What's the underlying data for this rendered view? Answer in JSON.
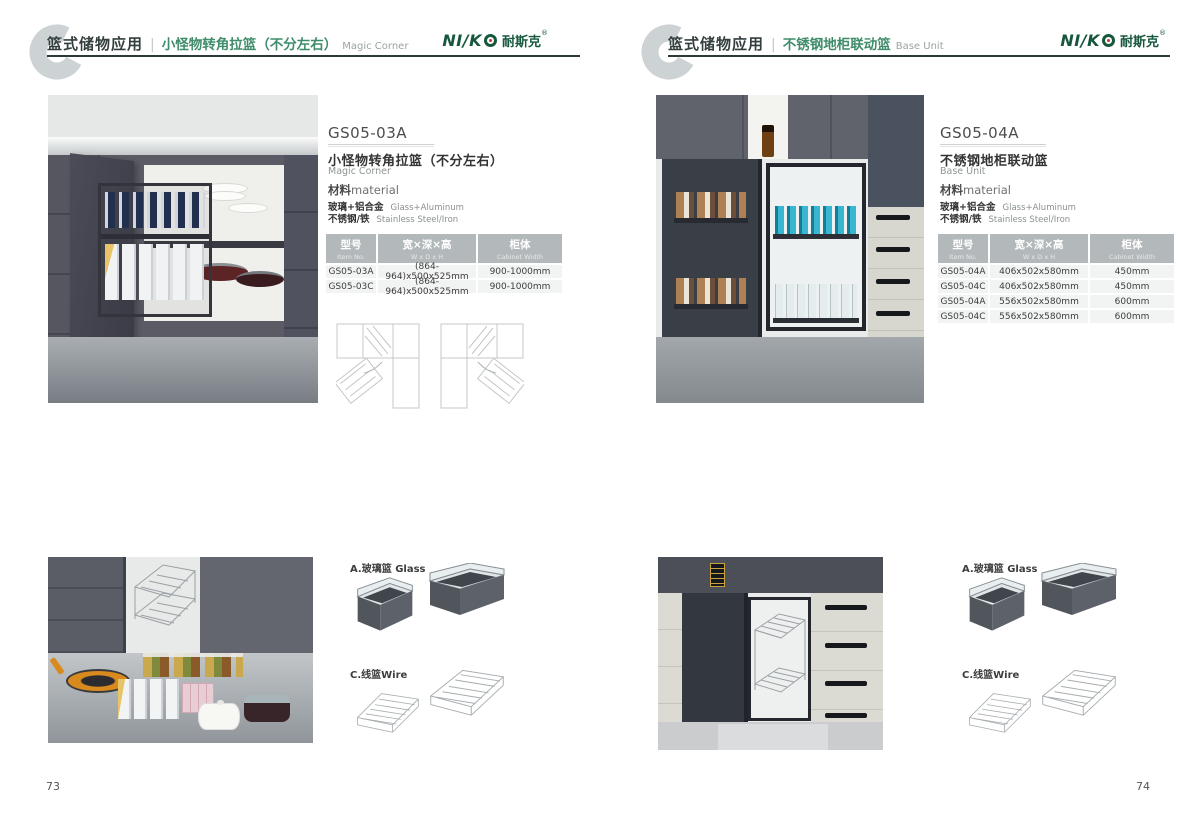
{
  "brand": {
    "latin": "NI/K",
    "cn": "耐斯克",
    "reg": "®"
  },
  "colors": {
    "accent_green": "#3f8c6a",
    "logo_green": "#17573d",
    "header_rule": "#2c3937",
    "table_header_gray": "#b3b9bb"
  },
  "pages": [
    {
      "page_number": "73",
      "header": {
        "category_cn": "篮式储物应用",
        "divider": "|",
        "title_cn": "小怪物转角拉篮（不分左右）",
        "title_en": "Magic Corner"
      },
      "product": {
        "code": "GS05-03A",
        "name_cn": "小怪物转角拉篮（不分左右）",
        "name_en": "Magic Corner"
      },
      "material": {
        "label_cn": "材料",
        "label_en": "material",
        "rows": [
          {
            "cn": "玻璃+铝合金",
            "en": "Glass+Aluminum"
          },
          {
            "cn": "不锈钢/铁",
            "en": "Stainless Steel/Iron"
          }
        ]
      },
      "spec_table": {
        "headers": [
          {
            "cn": "型号",
            "en": "Item No."
          },
          {
            "cn": "宽×深×高",
            "en": "W x D x H"
          },
          {
            "cn": "柜体",
            "en": "Cabinet Width"
          }
        ],
        "rows": [
          [
            "GS05-03A",
            "(864-964)x500x525mm",
            "900-1000mm"
          ],
          [
            "GS05-03C",
            "(864-964)x500x525mm",
            "900-1000mm"
          ]
        ]
      },
      "variants": [
        {
          "label": "A.玻璃篮 Glass"
        },
        {
          "label": "C.线篮Wire"
        }
      ]
    },
    {
      "page_number": "74",
      "header": {
        "category_cn": "篮式储物应用",
        "divider": "|",
        "title_cn": "不锈钢地柜联动篮",
        "title_en": "Base Unit"
      },
      "product": {
        "code": "GS05-04A",
        "name_cn": "不锈钢地柜联动篮",
        "name_en": "Base Unit"
      },
      "material": {
        "label_cn": "材料",
        "label_en": "material",
        "rows": [
          {
            "cn": "玻璃+铝合金",
            "en": "Glass+Aluminum"
          },
          {
            "cn": "不锈钢/铁",
            "en": "Stainless Steel/Iron"
          }
        ]
      },
      "spec_table": {
        "headers": [
          {
            "cn": "型号",
            "en": "Item No."
          },
          {
            "cn": "宽×深×高",
            "en": "W x D x H"
          },
          {
            "cn": "柜体",
            "en": "Cabinet Width"
          }
        ],
        "rows": [
          [
            "GS05-04A",
            "406x502x580mm",
            "450mm"
          ],
          [
            "GS05-04C",
            "406x502x580mm",
            "450mm"
          ],
          [
            "GS05-04A",
            "556x502x580mm",
            "600mm"
          ],
          [
            "GS05-04C",
            "556x502x580mm",
            "600mm"
          ]
        ]
      },
      "variants": [
        {
          "label": "A.玻璃篮 Glass"
        },
        {
          "label": "C.线篮Wire"
        }
      ]
    }
  ]
}
